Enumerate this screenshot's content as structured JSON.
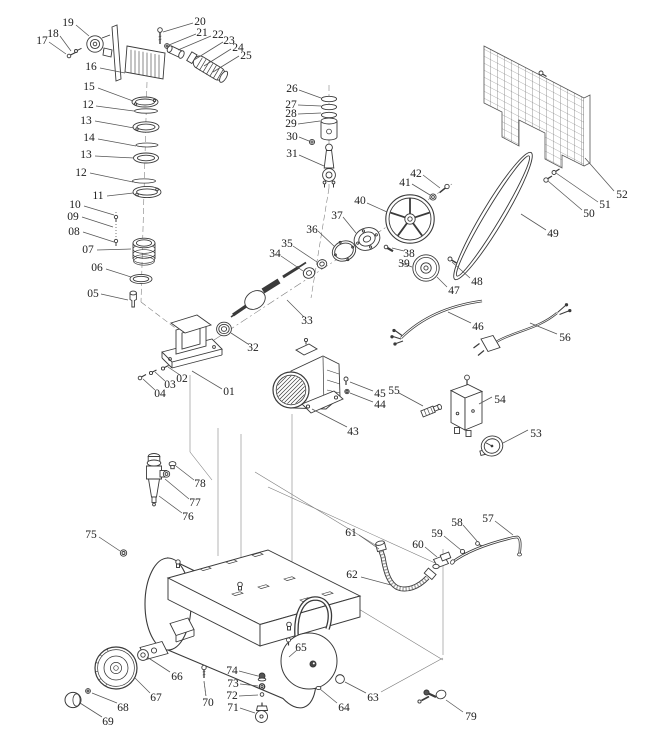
{
  "figure": {
    "kind": "exploded-parts-diagram",
    "colors": {
      "background": "#ffffff",
      "line": "#3a3a3a",
      "label_text": "#1c1c1c",
      "leader": "#555555"
    }
  },
  "diagram": {
    "labels": [
      {
        "text": "01",
        "x": 229,
        "y": 391,
        "leader": [
          222,
          389,
          192,
          371
        ]
      },
      {
        "text": "02",
        "x": 182,
        "y": 378,
        "leader": [
          180,
          375,
          168,
          367
        ]
      },
      {
        "text": "03",
        "x": 170,
        "y": 384,
        "leader": [
          165,
          381,
          155,
          372
        ]
      },
      {
        "text": "04",
        "x": 160,
        "y": 393,
        "leader": [
          155,
          390,
          143,
          379
        ]
      },
      {
        "text": "05",
        "x": 93,
        "y": 293,
        "leader": [
          101,
          294,
          128,
          300
        ]
      },
      {
        "text": "06",
        "x": 97,
        "y": 267,
        "leader": [
          106,
          269,
          131,
          277
        ]
      },
      {
        "text": "07",
        "x": 88,
        "y": 249,
        "leader": [
          97,
          250,
          131,
          249
        ]
      },
      {
        "text": "08",
        "x": 74,
        "y": 231,
        "leader": [
          83,
          232,
          114,
          242
        ]
      },
      {
        "text": "09",
        "x": 73,
        "y": 216,
        "leader": [
          82,
          217,
          113,
          227
        ]
      },
      {
        "text": "10",
        "x": 75,
        "y": 204,
        "leader": [
          84,
          206,
          114,
          215
        ]
      },
      {
        "text": "11",
        "x": 98,
        "y": 195,
        "leader": [
          107,
          196,
          133,
          193
        ]
      },
      {
        "text": "12",
        "x": 88,
        "y": 104,
        "leader": [
          96,
          106,
          134,
          111
        ]
      },
      {
        "text": "13",
        "x": 86,
        "y": 120,
        "leader": [
          95,
          121,
          134,
          128
        ]
      },
      {
        "text": "14",
        "x": 89,
        "y": 137,
        "leader": [
          98,
          139,
          136,
          146
        ]
      },
      {
        "text": "13",
        "x": 86,
        "y": 154,
        "leader": [
          95,
          156,
          134,
          158
        ]
      },
      {
        "text": "12",
        "x": 81,
        "y": 172,
        "leader": [
          90,
          173,
          133,
          182
        ]
      },
      {
        "text": "15",
        "x": 89,
        "y": 86,
        "leader": [
          98,
          88,
          133,
          101
        ]
      },
      {
        "text": "16",
        "x": 91,
        "y": 66,
        "leader": [
          100,
          68,
          125,
          73
        ]
      },
      {
        "text": "17",
        "x": 42,
        "y": 40,
        "leader": [
          49,
          42,
          66,
          54
        ]
      },
      {
        "text": "18",
        "x": 53,
        "y": 33,
        "leader": [
          60,
          36,
          71,
          51
        ]
      },
      {
        "text": "19",
        "x": 68,
        "y": 22,
        "leader": [
          76,
          25,
          89,
          36
        ]
      },
      {
        "text": "20",
        "x": 200,
        "y": 21,
        "leader": [
          193,
          23,
          163,
          32
        ]
      },
      {
        "text": "21",
        "x": 202,
        "y": 32,
        "leader": [
          196,
          34,
          169,
          45
        ]
      },
      {
        "text": "22",
        "x": 218,
        "y": 34,
        "leader": [
          211,
          36,
          178,
          50
        ]
      },
      {
        "text": "23",
        "x": 229,
        "y": 40,
        "leader": [
          223,
          42,
          194,
          60
        ]
      },
      {
        "text": "24",
        "x": 238,
        "y": 47,
        "leader": [
          231,
          49,
          204,
          66
        ]
      },
      {
        "text": "25",
        "x": 246,
        "y": 55,
        "leader": [
          239,
          56,
          213,
          72
        ]
      },
      {
        "text": "26",
        "x": 292,
        "y": 88,
        "leader": [
          299,
          90,
          321,
          98
        ]
      },
      {
        "text": "27",
        "x": 291,
        "y": 104,
        "leader": [
          298,
          105,
          321,
          106
        ]
      },
      {
        "text": "28",
        "x": 291,
        "y": 113,
        "leader": [
          298,
          114,
          321,
          113
        ]
      },
      {
        "text": "29",
        "x": 291,
        "y": 123,
        "leader": [
          298,
          124,
          320,
          121
        ]
      },
      {
        "text": "30",
        "x": 292,
        "y": 136,
        "leader": [
          299,
          137,
          309,
          141
        ]
      },
      {
        "text": "31",
        "x": 292,
        "y": 153,
        "leader": [
          299,
          155,
          324,
          166
        ]
      },
      {
        "text": "32",
        "x": 253,
        "y": 347,
        "leader": [
          248,
          344,
          231,
          333
        ]
      },
      {
        "text": "33",
        "x": 307,
        "y": 320,
        "leader": [
          304,
          317,
          287,
          300
        ]
      },
      {
        "text": "34",
        "x": 275,
        "y": 253,
        "leader": [
          281,
          256,
          303,
          271
        ]
      },
      {
        "text": "35",
        "x": 287,
        "y": 243,
        "leader": [
          293,
          246,
          317,
          262
        ]
      },
      {
        "text": "36",
        "x": 312,
        "y": 229,
        "leader": [
          318,
          231,
          335,
          247
        ]
      },
      {
        "text": "37",
        "x": 337,
        "y": 215,
        "leader": [
          343,
          217,
          356,
          233
        ]
      },
      {
        "text": "38",
        "x": 409,
        "y": 253,
        "leader": [
          404,
          251,
          392,
          248
        ]
      },
      {
        "text": "39",
        "x": 404,
        "y": 263,
        "leader": [
          399,
          262,
          412,
          267
        ]
      },
      {
        "text": "40",
        "x": 360,
        "y": 200,
        "leader": [
          367,
          203,
          387,
          212
        ]
      },
      {
        "text": "41",
        "x": 405,
        "y": 182,
        "leader": [
          412,
          184,
          430,
          195
        ]
      },
      {
        "text": "42",
        "x": 416,
        "y": 173,
        "leader": [
          423,
          175,
          440,
          188
        ]
      },
      {
        "text": "43",
        "x": 353,
        "y": 431,
        "leader": [
          347,
          427,
          312,
          409
        ]
      },
      {
        "text": "44",
        "x": 380,
        "y": 404,
        "leader": [
          373,
          402,
          350,
          393
        ]
      },
      {
        "text": "45",
        "x": 380,
        "y": 393,
        "leader": [
          373,
          391,
          350,
          382
        ]
      },
      {
        "text": "46",
        "x": 478,
        "y": 326,
        "leader": [
          471,
          323,
          448,
          312
        ]
      },
      {
        "text": "47",
        "x": 454,
        "y": 290,
        "leader": [
          447,
          287,
          437,
          277
        ]
      },
      {
        "text": "48",
        "x": 477,
        "y": 281,
        "leader": [
          470,
          278,
          452,
          262
        ]
      },
      {
        "text": "49",
        "x": 553,
        "y": 233,
        "leader": [
          546,
          230,
          521,
          214
        ]
      },
      {
        "text": "50",
        "x": 589,
        "y": 213,
        "leader": [
          582,
          210,
          548,
          181
        ]
      },
      {
        "text": "51",
        "x": 605,
        "y": 204,
        "leader": [
          598,
          202,
          556,
          173
        ]
      },
      {
        "text": "52",
        "x": 622,
        "y": 194,
        "leader": [
          614,
          191,
          585,
          158
        ]
      },
      {
        "text": "53",
        "x": 536,
        "y": 433,
        "leader": [
          528,
          430,
          503,
          443
        ]
      },
      {
        "text": "54",
        "x": 500,
        "y": 399,
        "leader": [
          492,
          397,
          479,
          404
        ]
      },
      {
        "text": "55",
        "x": 394,
        "y": 390,
        "leader": [
          399,
          393,
          423,
          406
        ]
      },
      {
        "text": "56",
        "x": 565,
        "y": 337,
        "leader": [
          557,
          334,
          530,
          323
        ]
      },
      {
        "text": "57",
        "x": 488,
        "y": 518,
        "leader": [
          495,
          521,
          513,
          535
        ]
      },
      {
        "text": "58",
        "x": 457,
        "y": 522,
        "leader": [
          463,
          525,
          477,
          541
        ]
      },
      {
        "text": "59",
        "x": 437,
        "y": 533,
        "leader": [
          444,
          536,
          461,
          550
        ]
      },
      {
        "text": "60",
        "x": 418,
        "y": 544,
        "leader": [
          425,
          547,
          437,
          557
        ]
      },
      {
        "text": "61",
        "x": 351,
        "y": 532,
        "leader": [
          359,
          535,
          379,
          549
        ]
      },
      {
        "text": "62",
        "x": 352,
        "y": 574,
        "leader": [
          361,
          577,
          391,
          585
        ]
      },
      {
        "text": "63",
        "x": 373,
        "y": 697,
        "leader": [
          366,
          693,
          345,
          682
        ]
      },
      {
        "text": "64",
        "x": 344,
        "y": 707,
        "leader": [
          337,
          703,
          320,
          689
        ]
      },
      {
        "text": "65",
        "x": 301,
        "y": 647,
        "leader": [
          297,
          650,
          289,
          657
        ]
      },
      {
        "text": "66",
        "x": 177,
        "y": 676,
        "leader": [
          170,
          672,
          147,
          657
        ]
      },
      {
        "text": "67",
        "x": 156,
        "y": 697,
        "leader": [
          150,
          693,
          135,
          678
        ]
      },
      {
        "text": "68",
        "x": 123,
        "y": 707,
        "leader": [
          117,
          703,
          92,
          693
        ]
      },
      {
        "text": "69",
        "x": 108,
        "y": 721,
        "leader": [
          102,
          717,
          80,
          703
        ]
      },
      {
        "text": "70",
        "x": 208,
        "y": 702,
        "leader": [
          206,
          696,
          204,
          681
        ]
      },
      {
        "text": "71",
        "x": 233,
        "y": 707,
        "leader": [
          240,
          708,
          255,
          713
        ]
      },
      {
        "text": "72",
        "x": 232,
        "y": 695,
        "leader": [
          239,
          696,
          258,
          695
        ]
      },
      {
        "text": "73",
        "x": 233,
        "y": 683,
        "leader": [
          240,
          684,
          258,
          686
        ]
      },
      {
        "text": "74",
        "x": 232,
        "y": 670,
        "leader": [
          239,
          671,
          258,
          676
        ]
      },
      {
        "text": "75",
        "x": 91,
        "y": 534,
        "leader": [
          99,
          537,
          120,
          551
        ]
      },
      {
        "text": "76",
        "x": 188,
        "y": 516,
        "leader": [
          182,
          513,
          159,
          496
        ]
      },
      {
        "text": "77",
        "x": 195,
        "y": 502,
        "leader": [
          189,
          499,
          165,
          479
        ]
      },
      {
        "text": "78",
        "x": 200,
        "y": 483,
        "leader": [
          194,
          480,
          176,
          466
        ]
      },
      {
        "text": "79",
        "x": 471,
        "y": 716,
        "leader": [
          463,
          712,
          446,
          700
        ]
      }
    ]
  }
}
